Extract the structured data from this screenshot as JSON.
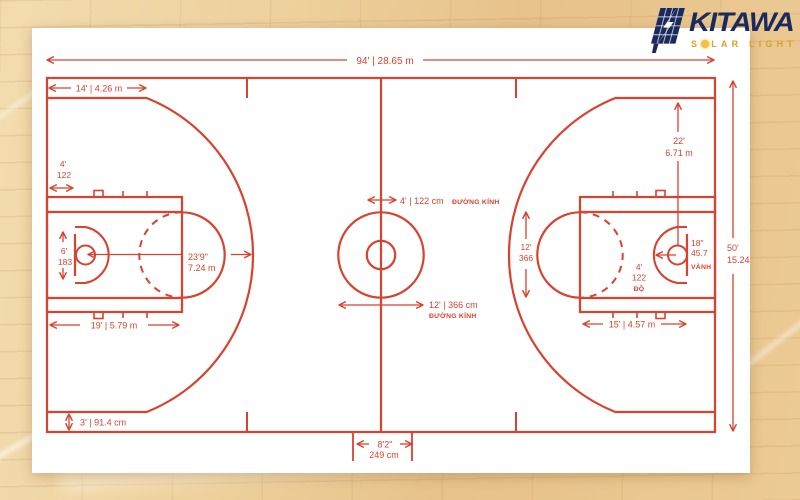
{
  "logo": {
    "brand": "KITAWA",
    "tagline_prefix": "S",
    "tagline_suffix": "LAR LIGHT",
    "brand_color": "#1b2a5e",
    "tagline_color": "#d9a126"
  },
  "diagram": {
    "line_color": "#d8422f",
    "card_color": "#ffffff",
    "labels": {
      "court_length": "94' | 28.65 m",
      "three_pt_straight": "14' | 4.26 m",
      "backboard_offset_ft": "4'",
      "backboard_offset_cm": "122",
      "backboard_width_ft": "6'",
      "backboard_width_cm": "183",
      "three_pt_radius_ft": "23'9\"",
      "three_pt_radius_m": "7.24 m",
      "key_length": "19' | 5.79 m",
      "center_inner_dia": "4' | 122 cm",
      "center_inner_dia_label": "ĐƯỜNG KÍNH",
      "center_outer_dia": "12' | 366 cm",
      "center_outer_dia_label": "ĐƯỜNG KÍNH",
      "lane_width_ft": "12'",
      "lane_width_cm": "366",
      "three_pt_top_ft": "22'",
      "three_pt_top_m": "6.71 m",
      "rim_in": "18\"",
      "rim_cm": "45.7",
      "rim_label": "VÀNH",
      "restricted_ft": "4'",
      "restricted_cm": "122",
      "restricted_label": "ĐỘ",
      "ft_line_dim": "15' | 4.57 m",
      "court_width_ft": "50'",
      "court_width_m": "15.24",
      "sideline_gap": "3' | 91.4 cm",
      "center_ticks_ft": "8'2\"",
      "center_ticks_cm": "249 cm"
    }
  }
}
